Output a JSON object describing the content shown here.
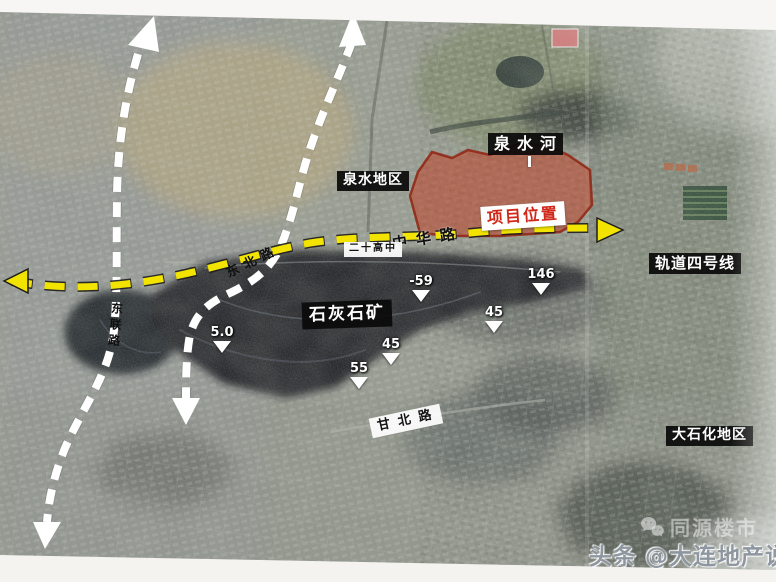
{
  "map": {
    "region_labels": {
      "quanshui_river": "泉水河",
      "quanshui_area": "泉水地区",
      "project_location": "项目位置",
      "no20_high_school": "二十高中",
      "limestone_quarry": "石灰石矿",
      "rail_line_4": "轨道四号线",
      "dashihua_area": "大石化地区"
    },
    "road_labels": {
      "zhonghua_road": "中华路",
      "dongbei_road": "东北路",
      "donglian_road": "东联路",
      "ganbei_road": "甘北路"
    },
    "elevation_markers": [
      {
        "value": "5.0"
      },
      {
        "value": "-59"
      },
      {
        "value": "45"
      },
      {
        "value": "55"
      },
      {
        "value": "146"
      },
      {
        "value": "45"
      }
    ],
    "colors": {
      "route_highlight_yellow": "#f2e400",
      "project_area_red": "#c23a1e",
      "project_label_text": "#d02818",
      "label_black_bg": "#0d0d0d",
      "road_white": "#ffffff"
    }
  },
  "watermark": {
    "platform_text": "头条",
    "account_text": "@大连地产说",
    "faint_logo_text": "同源楼市"
  }
}
